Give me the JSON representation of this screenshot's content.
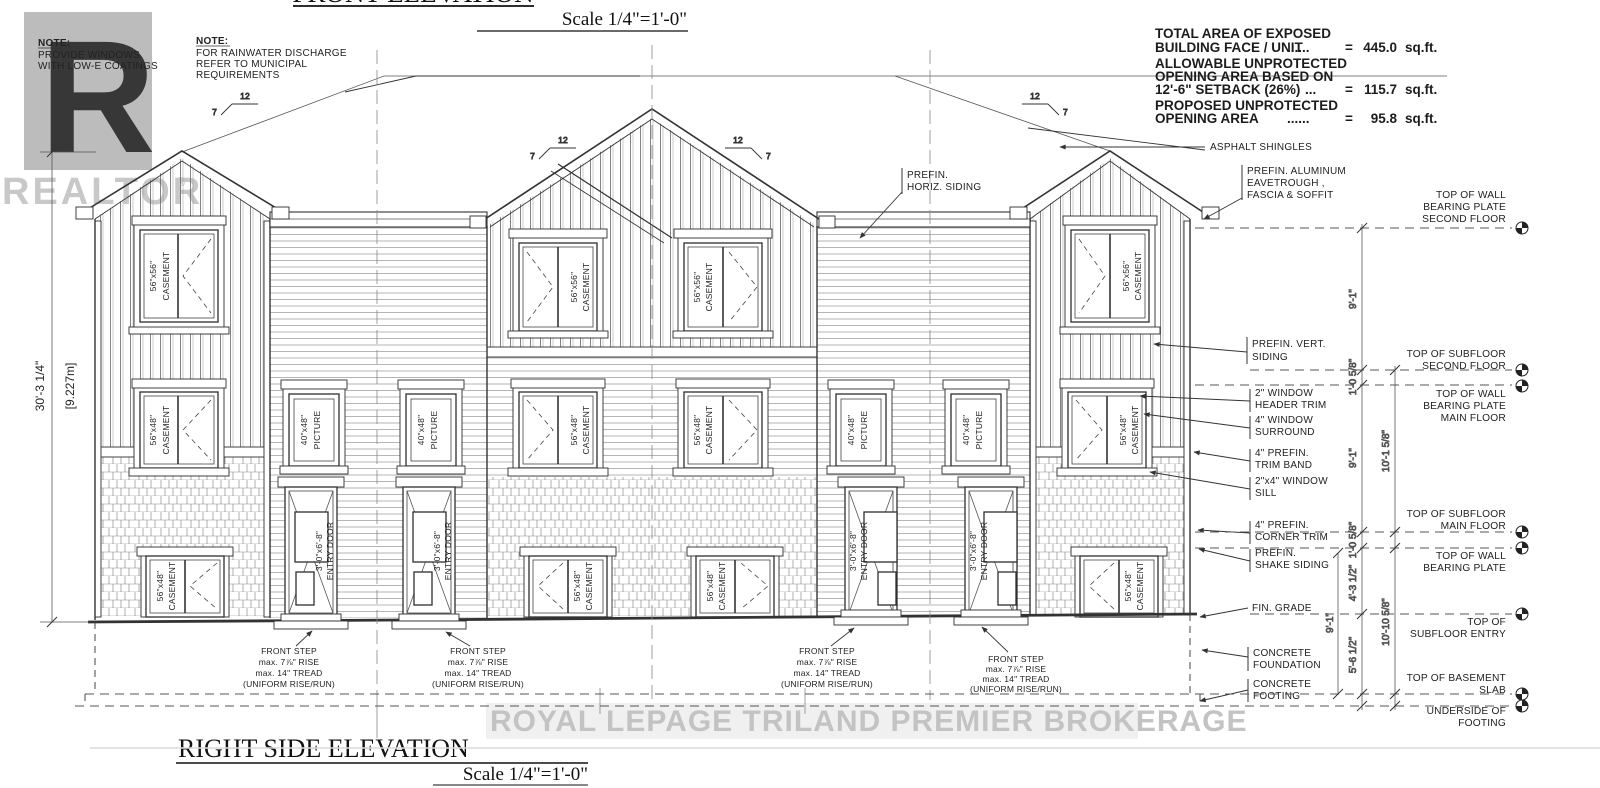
{
  "titles": {
    "front": "FRONT ELEVATION",
    "front_scale": "Scale 1/4\"=1'-0\"",
    "side": "RIGHT SIDE ELEVATION",
    "side_scale": "Scale 1/4\"=1'-0\""
  },
  "watermarks": {
    "logo_letter": "R",
    "logo_text": "REALTOR",
    "logo_reg": "®",
    "brokerage": "ROYAL LEPAGE TRILAND PREMIER BROKERAGE"
  },
  "notes": {
    "windows": {
      "title": "NOTE:",
      "lines": [
        "PROVIDE WINDOWS",
        "WITH LOW-E COATINGS"
      ]
    },
    "rainwater": {
      "title": "NOTE:",
      "lines": [
        "FOR RAINWATER DISCHARGE",
        "REFER TO MUNICIPAL",
        "REQUIREMENTS"
      ]
    }
  },
  "spec": {
    "rows": [
      {
        "lines": [
          "TOTAL AREA OF EXPOSED",
          "BUILDING FACE / UNIT"
        ],
        "dots": "......",
        "eq": "=",
        "value": "445.0",
        "unit": "sq.ft."
      },
      {
        "lines": [
          "ALLOWABLE UNPROTECTED",
          "OPENING AREA BASED ON",
          "12'-6\" SETBACK (26%)"
        ],
        "dots": "...",
        "eq": "=",
        "value": "115.7",
        "unit": "sq.ft."
      },
      {
        "lines": [
          "PROPOSED UNPROTECTED",
          "OPENING AREA"
        ],
        "dots": "......",
        "eq": "=",
        "value": "95.8",
        "unit": "sq.ft."
      }
    ]
  },
  "callouts": {
    "asphalt": "ASPHALT SHINGLES",
    "eavetrough": [
      "PREFIN. ALUMINUM",
      "EAVETROUGH ,",
      "FASCIA & SOFFIT"
    ],
    "horiz_siding": [
      "PREFIN.",
      "HORIZ. SIDING"
    ],
    "vert_siding": [
      "PREFIN. VERT.",
      "SIDING"
    ],
    "header_trim": [
      "2\" WINDOW",
      "HEADER TRIM"
    ],
    "surround": [
      "4\" WINDOW",
      "SURROUND"
    ],
    "trim_band": [
      "4\" PREFIN.",
      "TRIM BAND"
    ],
    "sill": [
      "2\"x4\" WINDOW",
      "SILL"
    ],
    "corner_trim": [
      "4\" PREFIN.",
      "CORNER TRIM"
    ],
    "shake_siding": [
      "PREFIN.",
      "SHAKE SIDING"
    ],
    "fin_grade": "FIN. GRADE",
    "foundation": [
      "CONCRETE",
      "FOUNDATION"
    ],
    "footing": [
      "CONCRETE",
      "FOOTING"
    ]
  },
  "datum_labels": {
    "wall_plate_2f": [
      "TOP OF WALL",
      "BEARING PLATE",
      "SECOND FLOOR"
    ],
    "subfloor_2f": [
      "TOP OF SUBFLOOR",
      "SECOND FLOOR"
    ],
    "wall_plate_main": [
      "TOP OF WALL",
      "BEARING PLATE",
      "MAIN FLOOR"
    ],
    "subfloor_main": [
      "TOP OF SUBFLOOR",
      "MAIN FLOOR"
    ],
    "wall_plate": [
      "TOP OF WALL",
      "BEARING PLATE"
    ],
    "subfloor_entry": [
      "TOP OF",
      "SUBFLOOR ENTRY"
    ],
    "basement_slab": [
      "TOP OF BASEMENT",
      "SLAB"
    ],
    "underside_footing": [
      "UNDERSIDE OF",
      "FOOTING"
    ]
  },
  "dimensions": {
    "overall_height": "30'-3 1/4\"",
    "overall_height_m": "[9.227m]",
    "second_floor": "9'-1\"",
    "floor_gap_upper": "1'-0 5/8\"",
    "main_floor": "9'-1\"",
    "upper_total": "10'-1 5/8\"",
    "floor_gap_lower": "1'-0 5/8\"",
    "entry_drop": "4'-3 1/2\"",
    "basement": "5'-6 1/2\"",
    "lower_total": "10'-10 5/8\"",
    "entry_to_slab": "9'-1\""
  },
  "labels": {
    "casement_56_56": [
      "56\"x56\"",
      "CASEMENT"
    ],
    "casement_56_48": [
      "56\"x48\"",
      "CASEMENT"
    ],
    "picture_40_48": [
      "40\"x48\"",
      "PICTURE"
    ],
    "entry_door": [
      "3'-0\"x6'-8\"",
      "ENTRY DOOR"
    ]
  },
  "step_note": [
    "FRONT STEP",
    "max. 7⅞\" RISE",
    "max. 14\" TREAD",
    "(UNIFORM RISE/RUN)"
  ],
  "pitch": {
    "run": "12",
    "rise": "7"
  }
}
